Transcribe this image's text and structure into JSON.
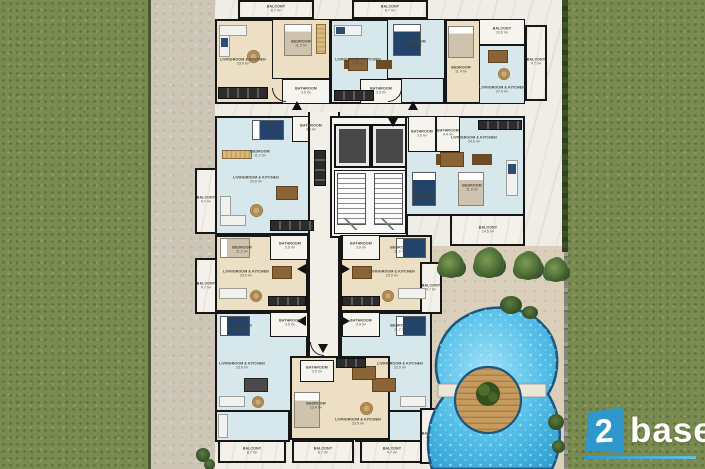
{
  "scene_title": "Residential block floor plan with pool, top view",
  "colors": {
    "brand_blue": "#2e97cb",
    "pool_water": "#45b7e3",
    "grass_green": "#7a8b51",
    "floor_cream": "#ecdfc4",
    "floor_blue": "#d7e8ec",
    "wall_black": "#161616"
  },
  "logo": {
    "number": "2",
    "word": "base"
  },
  "rooms": [
    {
      "label": "BALCONY",
      "area": "8.7 m²"
    },
    {
      "label": "LIVINGROOM & KITCHEN",
      "area": "23.9 m²"
    },
    {
      "label": "BEDROOM",
      "area": "11.2 m²"
    },
    {
      "label": "BATHROOM",
      "area": "3.9 m²"
    },
    {
      "label": "BALCONY",
      "area": "8.7 m²"
    },
    {
      "label": "LIVINGROOM & KITCHEN",
      "area": "23.9 m²"
    },
    {
      "label": "BEDROOM",
      "area": "11.2 m²"
    },
    {
      "label": "BATHROOM",
      "area": "3.9 m²"
    },
    {
      "label": "BALCONY",
      "area": "10.6 m²"
    },
    {
      "label": "BEDROOM",
      "area": "11.4 m²"
    },
    {
      "label": "LIVINGROOM & KITCHEN",
      "area": "27.4 m²"
    },
    {
      "label": "BATHROOM",
      "area": "4.4 m²"
    },
    {
      "label": "BALCONY",
      "area": "4.7 m²"
    },
    {
      "label": "BATHROOM",
      "area": "3.9 m²"
    },
    {
      "label": "BEDROOM",
      "area": "11.2 m²"
    },
    {
      "label": "LIVINGROOM & KITCHEN",
      "area": "23.9 m²"
    },
    {
      "label": "BALCONY",
      "area": "4.7 m²"
    },
    {
      "label": "BATHROOM",
      "area": "3.9 m²"
    },
    {
      "label": "LIVINGROOM & KITCHEN",
      "area": "24.6 m²"
    },
    {
      "label": "BEDROOM",
      "area": "11.2 m²"
    },
    {
      "label": "BEDROOM",
      "area": "11.9 m²"
    },
    {
      "label": "BALCONY",
      "area": "14.5 m²"
    },
    {
      "label": "BEDROOM",
      "area": "11.2 m²"
    },
    {
      "label": "BATHROOM",
      "area": "3.9 m²"
    },
    {
      "label": "LIVINGROOM & KITCHEN",
      "area": "23.9 m²"
    },
    {
      "label": "BALCONY",
      "area": "4.7 m²"
    },
    {
      "label": "BATHROOM",
      "area": "3.9 m²"
    },
    {
      "label": "BEDROOM",
      "area": "11.2 m²"
    },
    {
      "label": "LIVINGROOM & KITCHEN",
      "area": "23.9 m²"
    },
    {
      "label": "BALCONY",
      "area": "4.7 m²"
    },
    {
      "label": "BEDROOM",
      "area": "11.2 m²"
    },
    {
      "label": "BATHROOM",
      "area": "3.9 m²"
    },
    {
      "label": "LIVINGROOM & KITCHEN",
      "area": "23.9 m²"
    },
    {
      "label": "BALCONY",
      "area": "8.7 m²"
    },
    {
      "label": "BATHROOM",
      "area": "3.9 m²"
    },
    {
      "label": "BEDROOM",
      "area": "11.2 m²"
    },
    {
      "label": "LIVINGROOM & KITCHEN",
      "area": "23.9 m²"
    },
    {
      "label": "BALCONY",
      "area": "4.7 m²"
    },
    {
      "label": "BATHROOM",
      "area": "3.9 m²"
    },
    {
      "label": "BEDROOM",
      "area": "13.4 m²"
    },
    {
      "label": "LIVINGROOM & KITCHEN",
      "area": "23.9 m²"
    },
    {
      "label": "BALCONY",
      "area": "8.7 m²"
    },
    {
      "label": "BALCONY",
      "area": "4.7 m²"
    }
  ]
}
